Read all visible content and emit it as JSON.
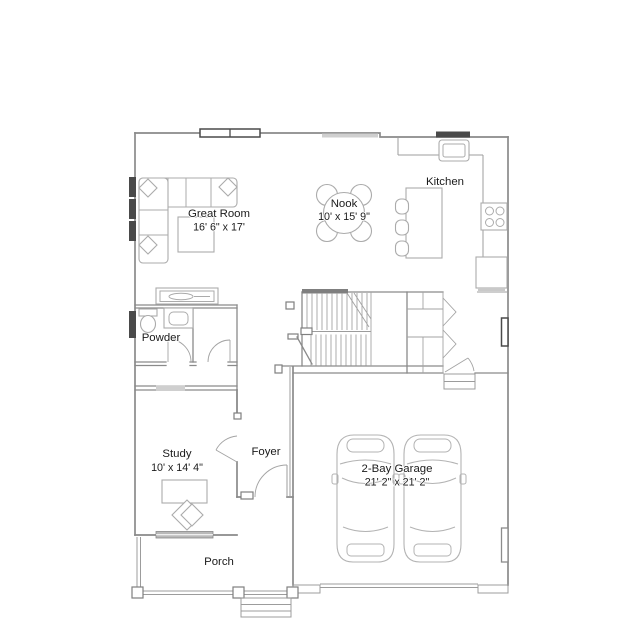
{
  "rooms": {
    "great_room": {
      "label": "Great Room",
      "dimensions": "16' 6\" x 17'"
    },
    "nook": {
      "label": "Nook",
      "dimensions": "10' x 15' 9\""
    },
    "kitchen": {
      "label": "Kitchen"
    },
    "powder": {
      "label": "Powder"
    },
    "study": {
      "label": "Study",
      "dimensions": "10' x 14' 4\""
    },
    "foyer": {
      "label": "Foyer"
    },
    "garage": {
      "label": "2-Bay Garage",
      "dimensions": "21' 2\" x 21' 2\""
    },
    "porch": {
      "label": "Porch"
    }
  },
  "colors": {
    "wall_line": "#8a8a8a",
    "furniture_line": "#ababab",
    "window_dark": "#4a4a4a",
    "label_text": "#1b1b1b",
    "background": "#ffffff"
  }
}
